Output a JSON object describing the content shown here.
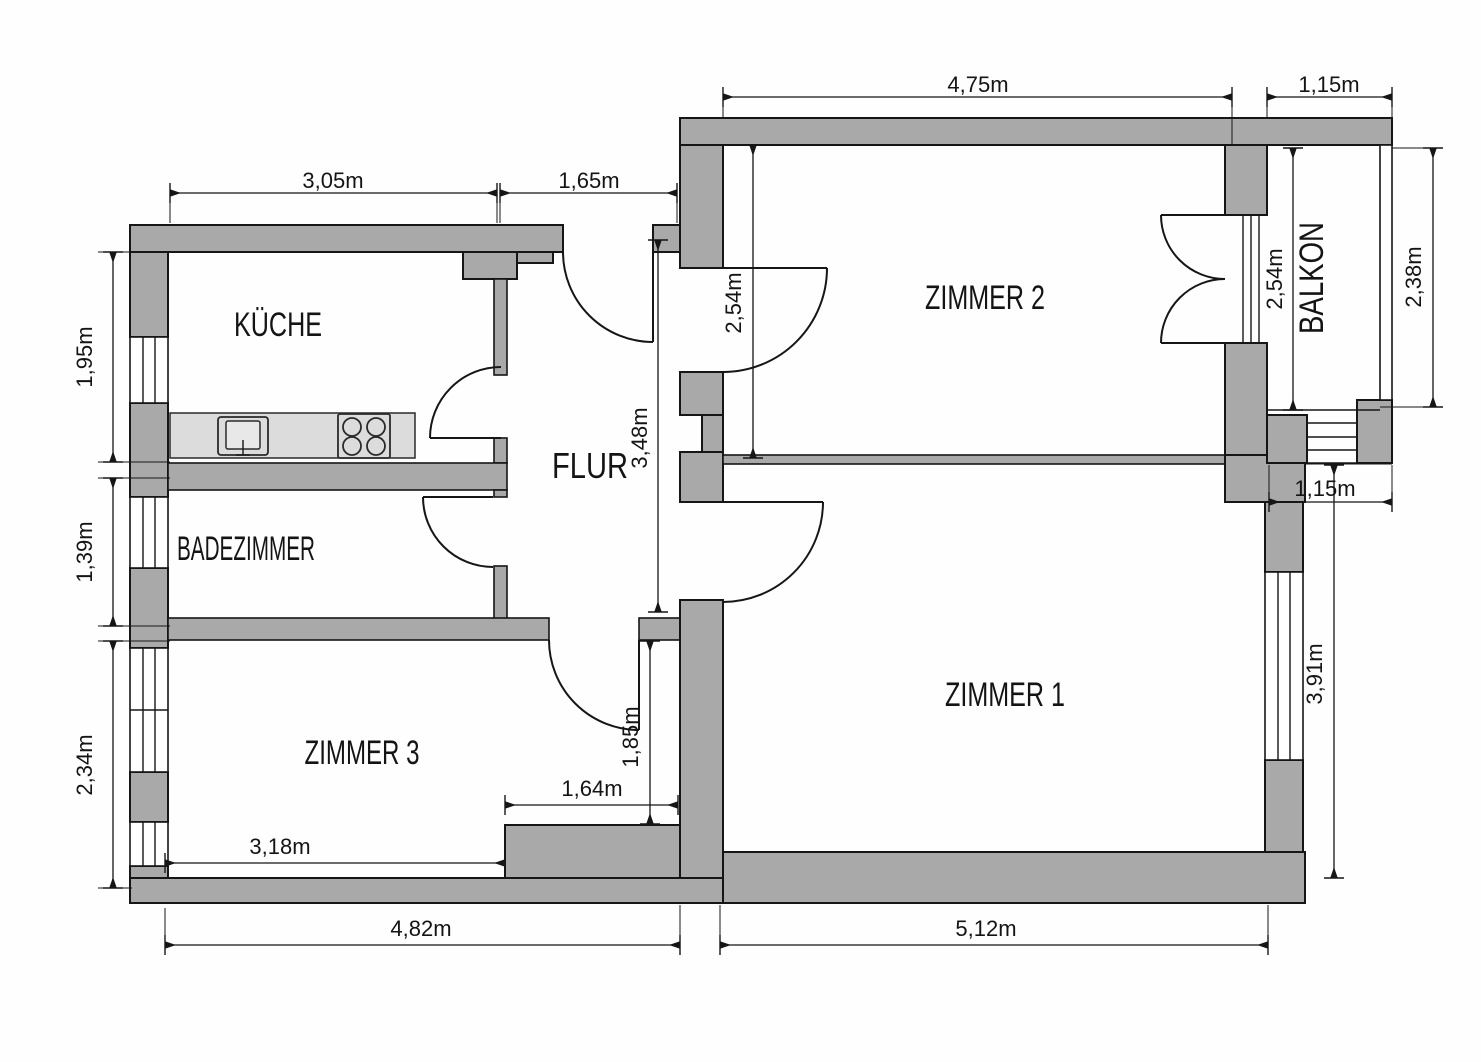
{
  "rooms": {
    "kueche": "KÜCHE",
    "badezimmer": "BADEZIMMER",
    "zimmer3": "ZIMMER 3",
    "flur": "FLUR",
    "zimmer2": "ZIMMER 2",
    "zimmer1": "ZIMMER 1",
    "balkon": "BALKON"
  },
  "dims": {
    "kueche_w": "3,05m",
    "flur_w": "1,65m",
    "zimmer2_w": "4,75m",
    "balkon_w": "1,15m",
    "kueche_h": "1,95m",
    "bad_h": "1,39m",
    "zimmer3_h": "2,34m",
    "zimmer2_h": "2,54m",
    "flur_h": "3,48m",
    "balkon_h_inner": "2,54m",
    "balkon_h_outer": "2,38m",
    "balkon_w_lower": "1,15m",
    "zimmer1_h": "3,91m",
    "niche_h": "1,85m",
    "niche_w": "1,64m",
    "zimmer3_w": "3,18m",
    "left_section_w": "4,82m",
    "zimmer1_w": "5,12m"
  },
  "colors": {
    "wall_fill": "#a9a9a9",
    "counter_fill": "#dcdcdc",
    "line": "#161616",
    "background": "#fefefe"
  }
}
